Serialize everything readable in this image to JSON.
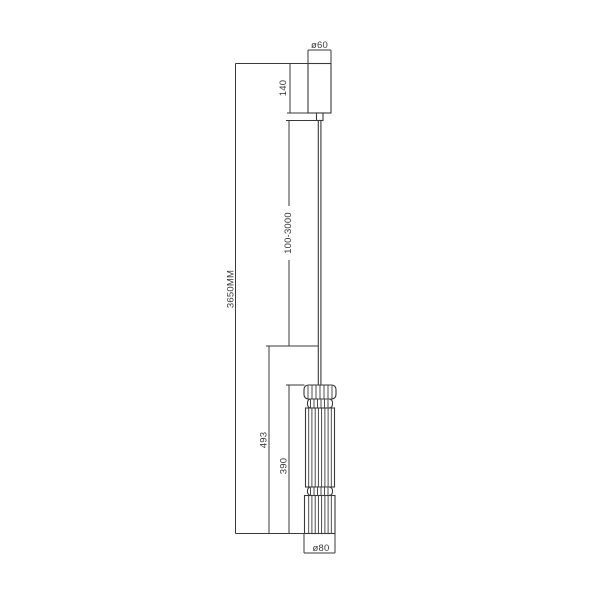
{
  "drawing": {
    "labels": {
      "canopy_diameter": "ø60",
      "canopy_height": "140",
      "cable_length_range": "100-3000",
      "overall_height": "3650MM",
      "shade_overall_height": "493",
      "shade_body_height": "390",
      "shade_diameter": "ø80"
    },
    "colors": {
      "line": "#3a3a3a",
      "background": "#ffffff"
    }
  }
}
